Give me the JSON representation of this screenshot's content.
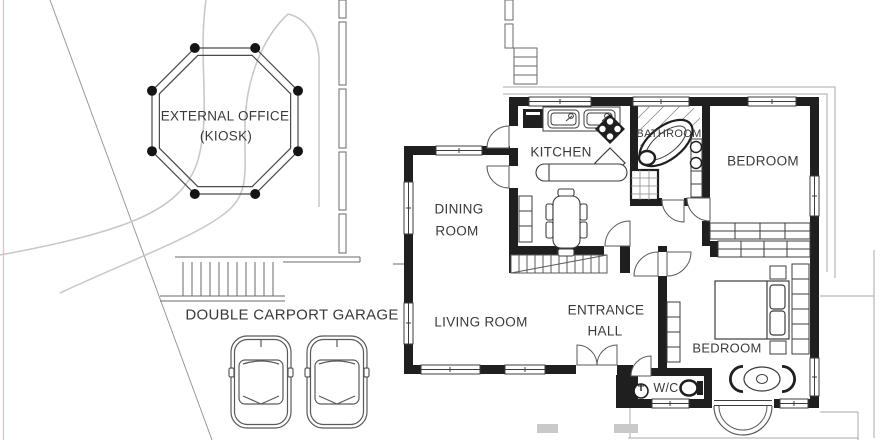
{
  "site": {
    "kiosk_line1": "EXTERNAL OFFICE",
    "kiosk_line2": "(KIOSK)",
    "garage_label": "DOUBLE CARPORT GARAGE"
  },
  "rooms": {
    "kitchen": "KITCHEN",
    "bathroom": "BATHROOM",
    "bedroom_top": "BEDROOM",
    "bedroom_bottom": "BEDROOM",
    "dining_line1": "DINING",
    "dining_line2": "ROOM",
    "living": "LIVING ROOM",
    "entrance_line1": "ENTRANCE",
    "entrance_line2": "HALL",
    "wc": "W/C"
  },
  "colors": {
    "wall": "#1f1f1f",
    "line_dark": "#4a4a4a",
    "line_light": "#c9c9c9",
    "text": "#3a3a3a",
    "plot_boundary_pink": "#efb9ca",
    "step_fill": "#c9c9c9"
  }
}
